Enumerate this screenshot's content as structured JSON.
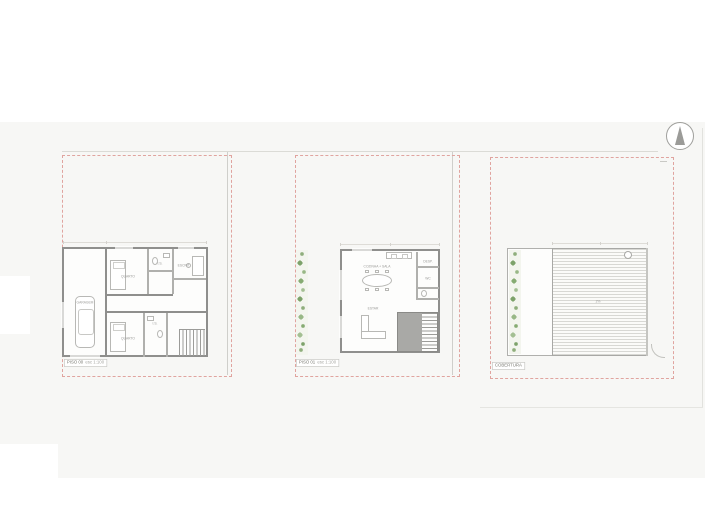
{
  "drawing_labels": {
    "note": ""
  },
  "colors": {
    "background": "#ffffff",
    "site_band": "#f7f7f5",
    "plot_boundary_red": "#e0a49f",
    "wall_gray": "#8f8f8d",
    "plant_green_dark": "#7da26a",
    "plant_green_light": "#a3bf92",
    "deck_line": "#d8d8d4"
  },
  "north_arrow": {
    "name": "north-arrow"
  },
  "plans": [
    {
      "id": "piso-00",
      "label": "PISO 00",
      "scale": "esc 1:100",
      "rooms": {
        "garage": "GARAGEM",
        "bedroom1": "QUARTO",
        "bath1": "I.S.",
        "office": "ESCRIT.",
        "bedroom2": "QUARTO",
        "bath2": "I.S."
      }
    },
    {
      "id": "piso-01",
      "label": "PISO 01",
      "scale": "esc 1:100",
      "rooms": {
        "kitchen_dining": "COZINHA + SALA",
        "pantry": "DESP.",
        "wc": "WC",
        "living": "ESTAR"
      }
    },
    {
      "id": "cobertura",
      "label": "COBERTURA",
      "scale": "",
      "annotations": {
        "slope": "2%"
      }
    }
  ]
}
